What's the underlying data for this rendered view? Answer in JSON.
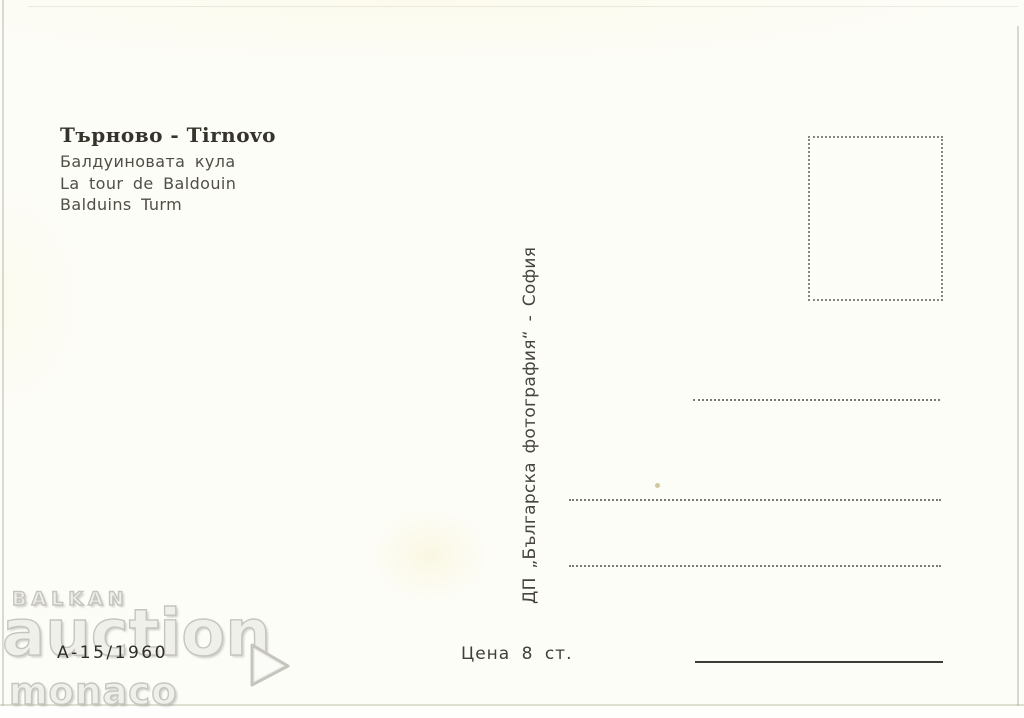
{
  "postcard": {
    "title": "Търново - Tirnovo",
    "captions": [
      "Балдуиновата кула",
      "La tour de Baldouin",
      "Balduins Turm"
    ],
    "publisher": "ДП „Българска фотография“ - София",
    "catalog_number": "А-15/1960",
    "price": "Цена 8 ст.",
    "watermark": {
      "line1": "BALKAN",
      "line2": "auction",
      "line3": "monaco",
      "arrow_icon": "triangle-right"
    },
    "colors": {
      "card_bg": "#fdfdf8",
      "title_ink": "#35332b",
      "caption_ink": "#504e45",
      "line_ink": "#3c3b35",
      "watermark_gray": "#c6c5bd",
      "speck": "#cfc49b"
    }
  }
}
